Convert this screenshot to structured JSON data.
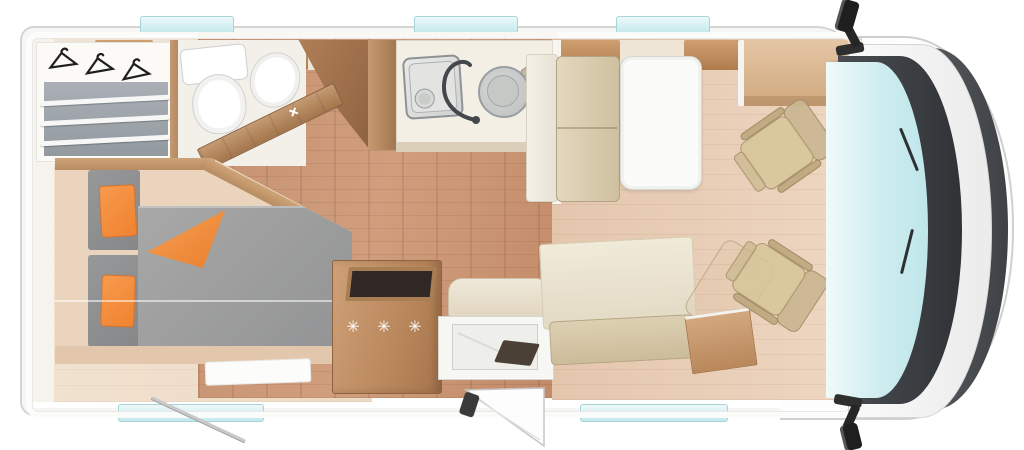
{
  "scene": {
    "type": "motorhome-floorplan-top-view",
    "fridge_symbols": "✳ ✳ ✳"
  },
  "palette": {
    "body_white": "#ffffff",
    "glass_teal": "#cdecef",
    "floor_corridor_wood": "#c89573",
    "floor_dinette": "#e8ccb4",
    "floor_bedroom": "#f0e1ce",
    "furniture_wood": "#b98a62",
    "mattress_gray": "#9c9c9c",
    "pillow_orange": "#f28c3e",
    "seat_beige": "#d2c194",
    "dashboard_dark": "#3d4044",
    "mirror_black": "#2a2a2a"
  },
  "icons": [
    {
      "name": "clothes-hanger-icon",
      "meaning": "wardrobe hanging rail"
    },
    {
      "name": "faucet-icon",
      "meaning": "kitchen sink tap"
    },
    {
      "name": "snowflake-symbols",
      "meaning": "refrigerator / freezer"
    },
    {
      "name": "door-swing-icon",
      "meaning": "open entry door"
    },
    {
      "name": "side-mirror-icon",
      "meaning": "cab side mirrors"
    }
  ],
  "counts": {
    "cab_seats": 2,
    "top_windows": 3,
    "bottom_windows": 2
  }
}
